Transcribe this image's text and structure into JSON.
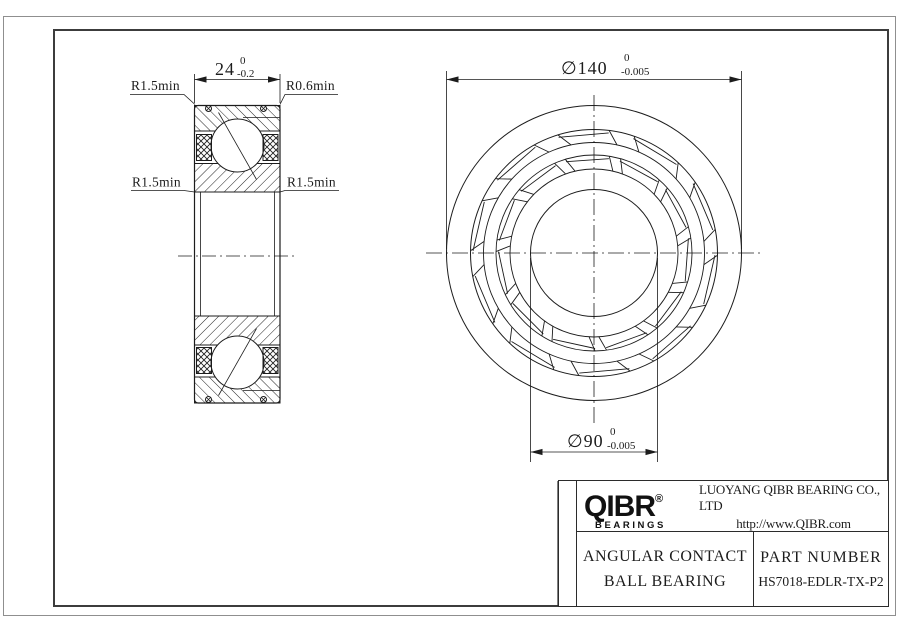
{
  "drawing": {
    "section_view": {
      "width_dim": {
        "value": "24",
        "tol_upper": "0",
        "tol_lower": "-0.2"
      },
      "radius_labels": {
        "top_left": "R1.5min",
        "top_right": "R0.6min",
        "mid_left": "R1.5min",
        "mid_right": "R1.5min"
      }
    },
    "front_view": {
      "outer_dia_dim": {
        "value": "∅140",
        "tol_upper": "0",
        "tol_lower": "-0.005"
      },
      "bore_dia_dim": {
        "value": "∅90",
        "tol_upper": "0",
        "tol_lower": "-0.005"
      }
    }
  },
  "title_block": {
    "logo_text": "QIBR",
    "logo_registered": "®",
    "logo_subtext": "BEARINGS",
    "company_name": "LUOYANG QIBR BEARING CO., LTD",
    "website": "http://www.QIBR.com",
    "product_type_line1": "ANGULAR CONTACT",
    "product_type_line2": "BALL BEARING",
    "part_number_label": "PART NUMBER",
    "part_number": "HS7018-EDLR-TX-P2"
  }
}
